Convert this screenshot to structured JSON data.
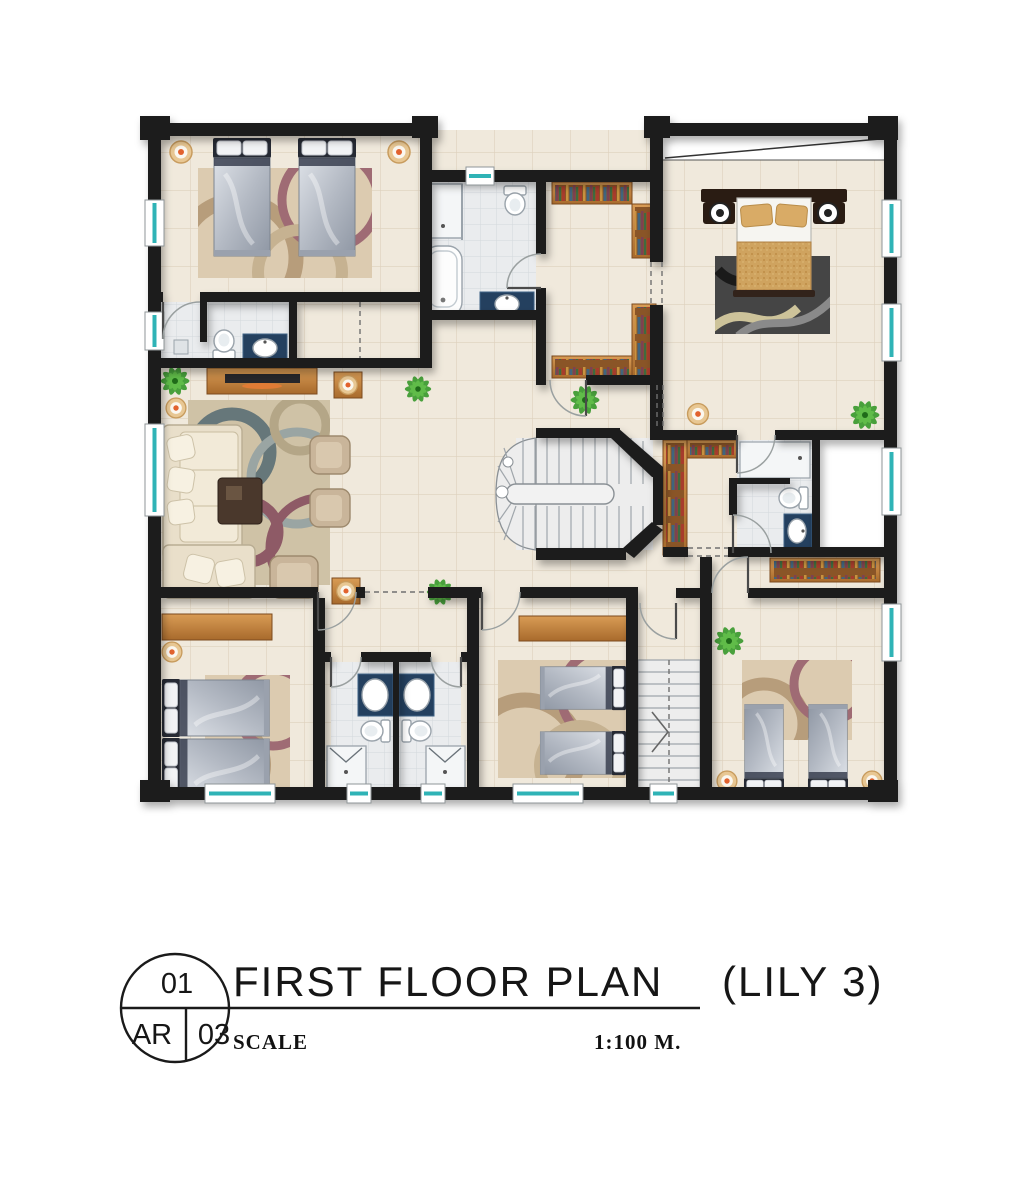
{
  "title_block": {
    "sheet_number": "01",
    "discipline_code": "AR",
    "sheet_total": "03",
    "title": "FIRST FLOOR PLAN",
    "variant": "(LILY 3)",
    "scale_label": "SCALE",
    "scale_value": "1:100 M."
  },
  "colors": {
    "wall": "#1d1d1f",
    "floor_tile": "#f0e9dc",
    "tile_line": "#ded1bd",
    "bath_tile": "#eaecee",
    "window_glass": "#2fb3b6",
    "wood": "#c0813d",
    "bed_silver": "#b4bac4",
    "headboard_navy": "#262a34",
    "master_blanket": "#cfa35f",
    "rug_dark": "#454545",
    "rug_beige": "#dccbb0",
    "sofa_cream": "#e9dfca",
    "plant_green": "#37992b",
    "lamp_accent": "#e2622e"
  },
  "icons": [
    "twin-bed",
    "double-bed",
    "sofa",
    "armchair",
    "coffee-table",
    "tv-console",
    "rug",
    "wardrobe",
    "bookshelf",
    "toilet",
    "sink",
    "bathtub",
    "shower",
    "staircase",
    "plant",
    "floor-lamp",
    "window",
    "door"
  ]
}
